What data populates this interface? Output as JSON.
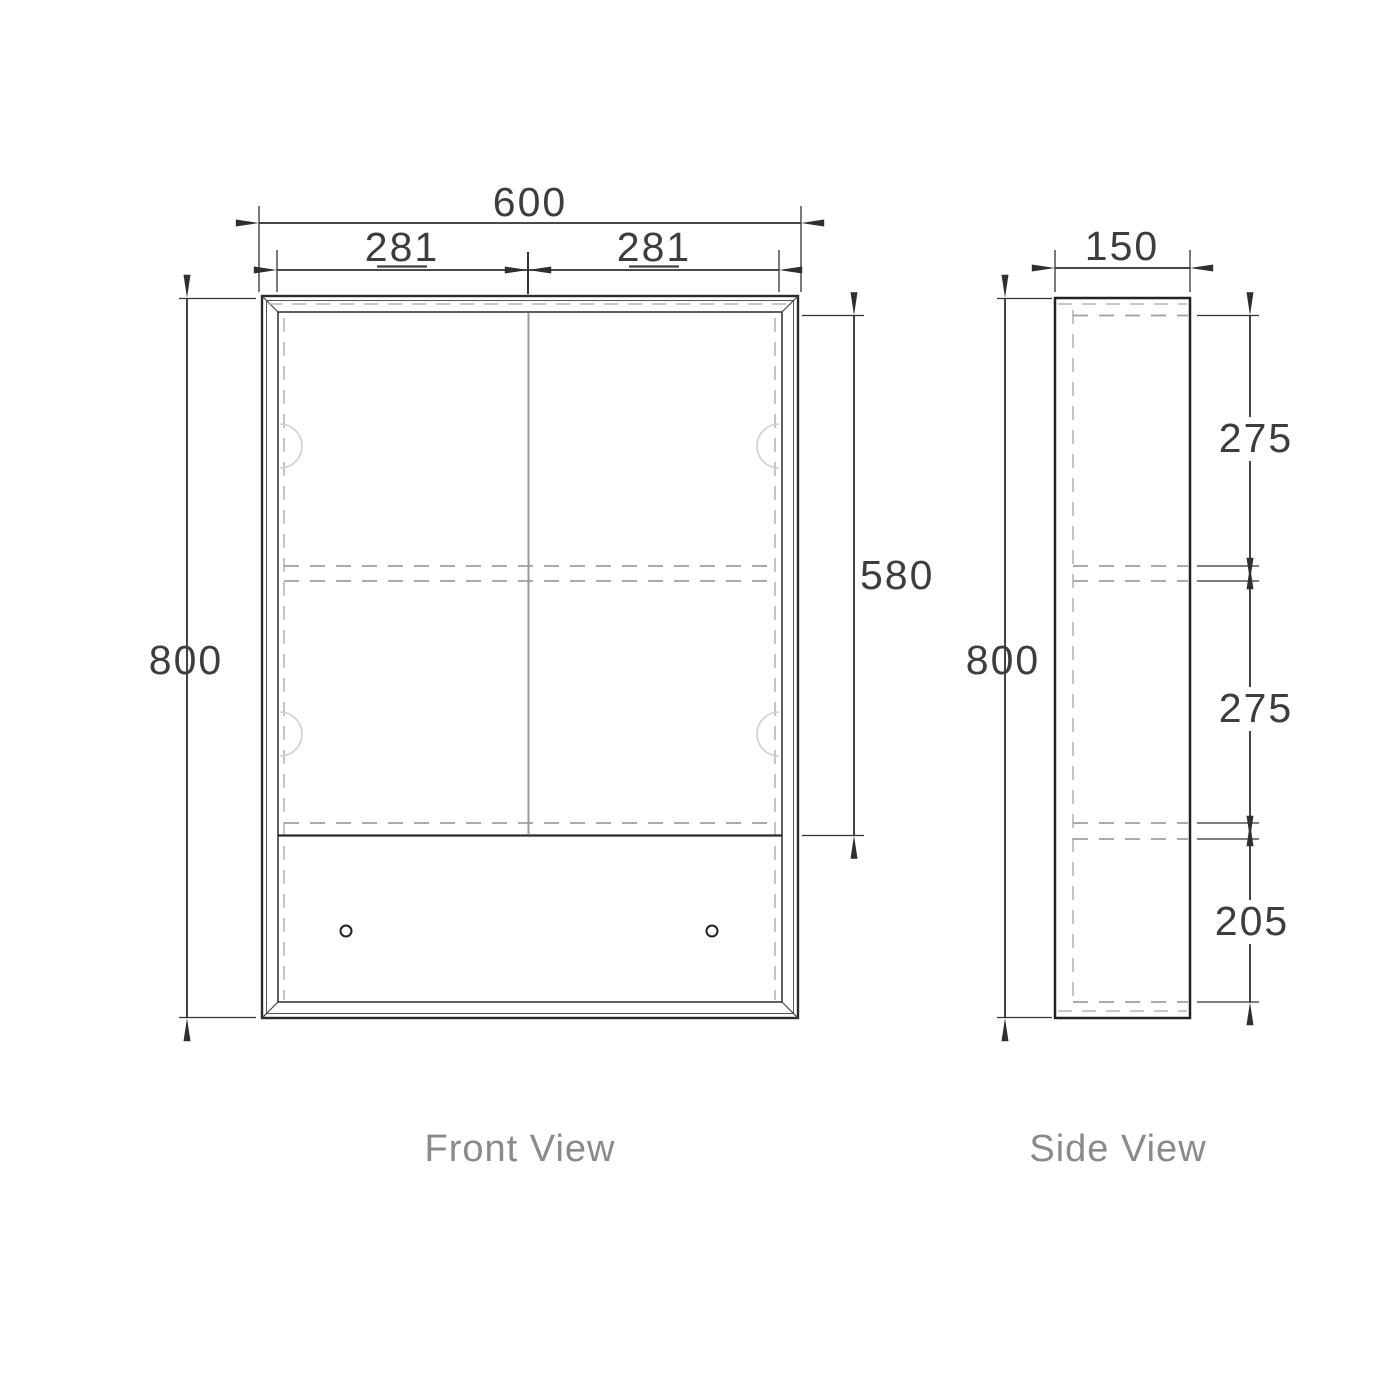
{
  "drawing": {
    "title": "Mirror cabinet dimension drawing",
    "front": {
      "label": "Front View",
      "overall_width": "600",
      "door_width_left": "281",
      "door_width_right": "281",
      "overall_height": "800",
      "door_height": "580"
    },
    "side": {
      "label": "Side View",
      "depth": "150",
      "overall_height": "800",
      "section_top": "275",
      "section_middle": "275",
      "section_bottom": "205"
    },
    "colors": {
      "line": "#2b2b2b",
      "dimension_line": "#333333",
      "hidden_line": "#b5b5b5",
      "shelf_line": "#9e9e9e",
      "dim_text": "#3d3d3d",
      "label_text": "#8a8a8a"
    }
  }
}
